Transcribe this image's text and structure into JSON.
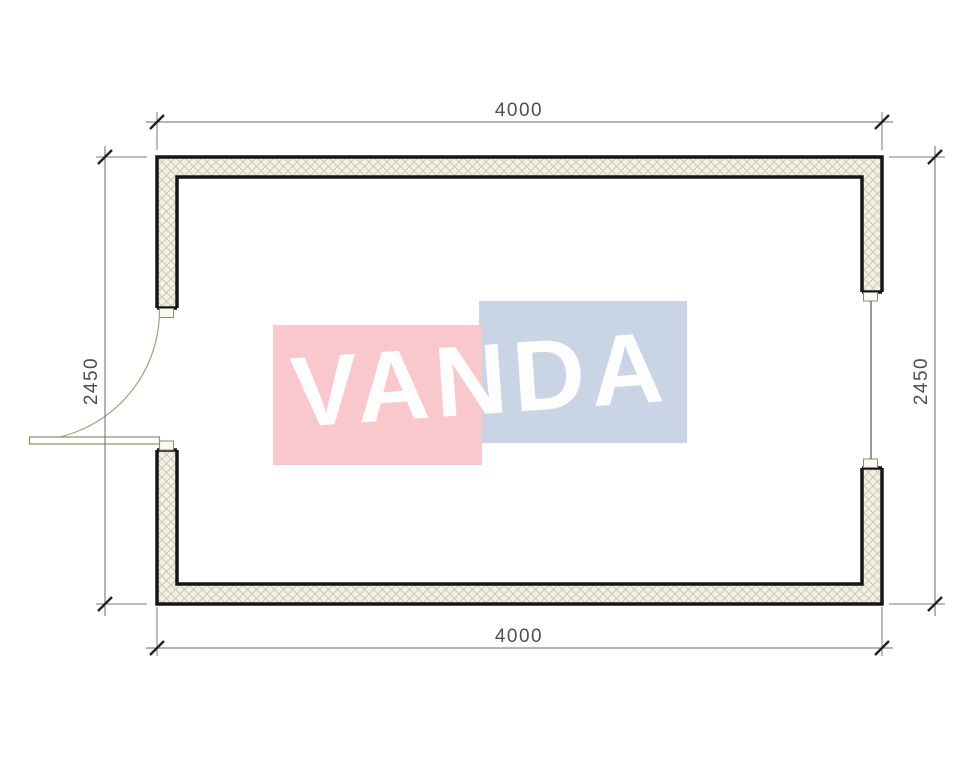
{
  "floor_plan": {
    "dimensions": {
      "top": "4000",
      "bottom": "4000",
      "left": "2450",
      "right": "2450"
    },
    "watermark": {
      "text": "VANDA",
      "pink": "#f9c8cd",
      "blue": "#c9d5e4",
      "text_color": "#fdfdfd"
    },
    "colors": {
      "wall_outline": "#161616",
      "wall_fill": "#f1f0e2",
      "hatch_line": "#c5c4b2",
      "dimension_line": "#6a6a6a",
      "dimension_text": "#4f4f4f",
      "tick": "#222222",
      "door_leaf": "#8f8f68",
      "door_arc": "#a3a37d",
      "window_glass": "#555555"
    }
  }
}
